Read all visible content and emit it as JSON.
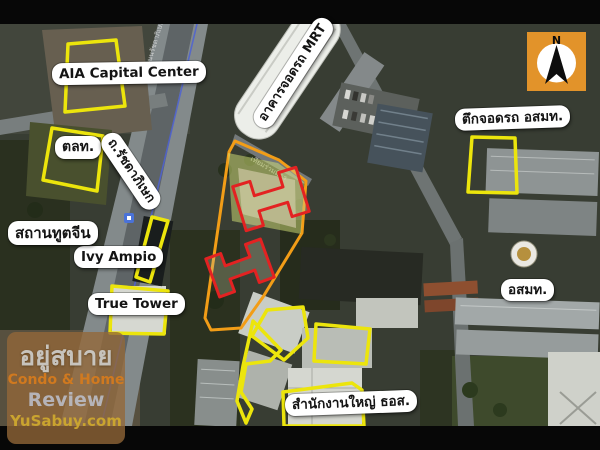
{
  "colors": {
    "highlight_yellow": "#ece50c",
    "site_orange": "#f29d17",
    "building_red": "#e32222",
    "compass_bg": "#e2932a",
    "route_blue": "#4e62d4"
  },
  "labels": {
    "aia_capital_center": "AIA Capital Center",
    "set": "ตลท.",
    "chinese_embassy": "สถานทูตจีน",
    "ivy_ampio": "Ivy Ampio",
    "true_tower": "True Tower",
    "mrt_parking": "อาคารจอดรถ MRT",
    "ratchadaphisek_rd": "ถ.รัชดาภิเษก",
    "mcot_parking": "ตึกจอดรถ อสมท.",
    "mcot": "อสมท.",
    "ghb_headquarters": "สำนักงานใหญ่ ธอส."
  },
  "compass": {
    "north_label": "N"
  },
  "road_names": {
    "ratchadaphisek": "ถนนรัชดาภิเษก",
    "thiam_ruam_mit": "เทียมร่วมมิตร"
  },
  "watermark": {
    "site_name_thai": "อยู่สบาย",
    "tagline": "Condo & Home",
    "tagline2": "Review",
    "site_url": "YuSabuy.com"
  }
}
